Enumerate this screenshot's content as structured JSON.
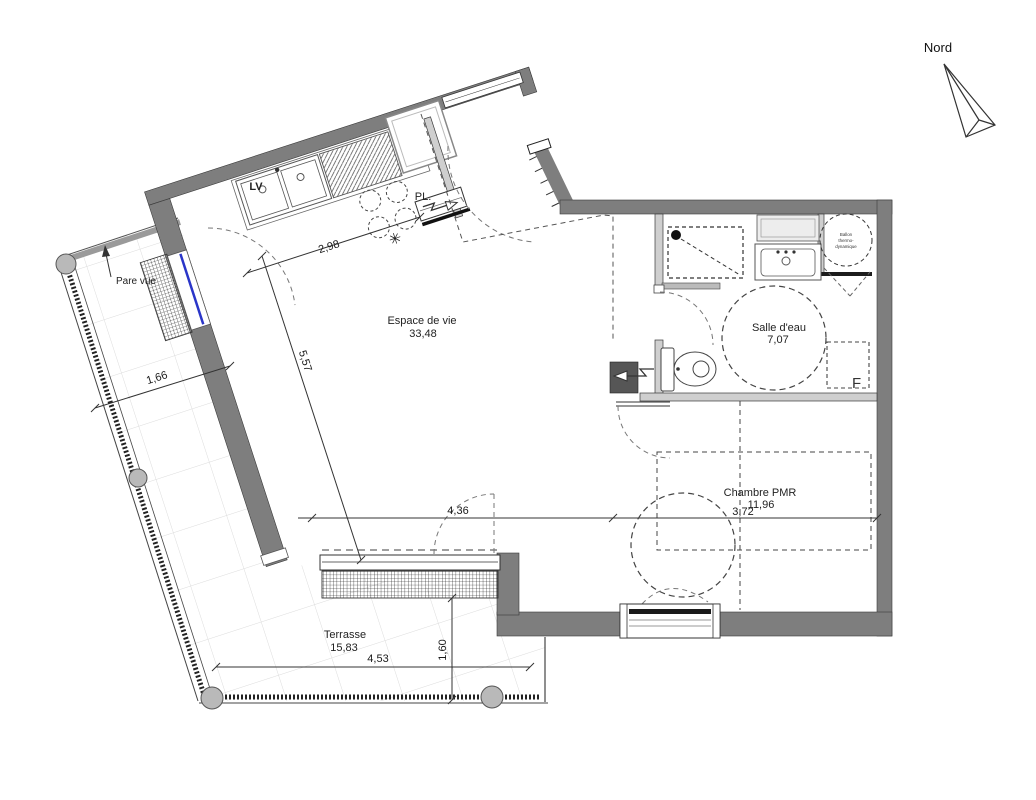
{
  "compass": {
    "label": "Nord"
  },
  "rooms": {
    "living": {
      "name": "Espace de vie",
      "area": "33,48"
    },
    "bathroom": {
      "name": "Salle d'eau",
      "area": "7,07"
    },
    "bedroom": {
      "name": "Chambre PMR",
      "area": "11,96"
    },
    "terrace": {
      "name": "Terrasse",
      "area": "15,83"
    }
  },
  "fixtures": {
    "dishwasher_label": "LV",
    "closet_label": "PL.",
    "privacy_screen_label": "Pare vue",
    "water_heater_lines": [
      "Ballon",
      "thermo-",
      "dynamique"
    ],
    "bedroom_marker": "F",
    "vent_star": "✳"
  },
  "dimensions": {
    "kitchen_width": "2,98",
    "living_depth": "5,57",
    "living_width": "4,36",
    "bedroom_width": "3,72",
    "terrace_top_width": "1,66",
    "terrace_bottom_width": "4,53",
    "terrace_side_depth": "1,60"
  },
  "colors": {
    "wall": "#7e7e7e",
    "partition_fill": "#cfcfcf",
    "glazing_blue": "#2a35c8",
    "post_fill": "#b9b9b9",
    "tile_line": "#dcdcdc"
  }
}
